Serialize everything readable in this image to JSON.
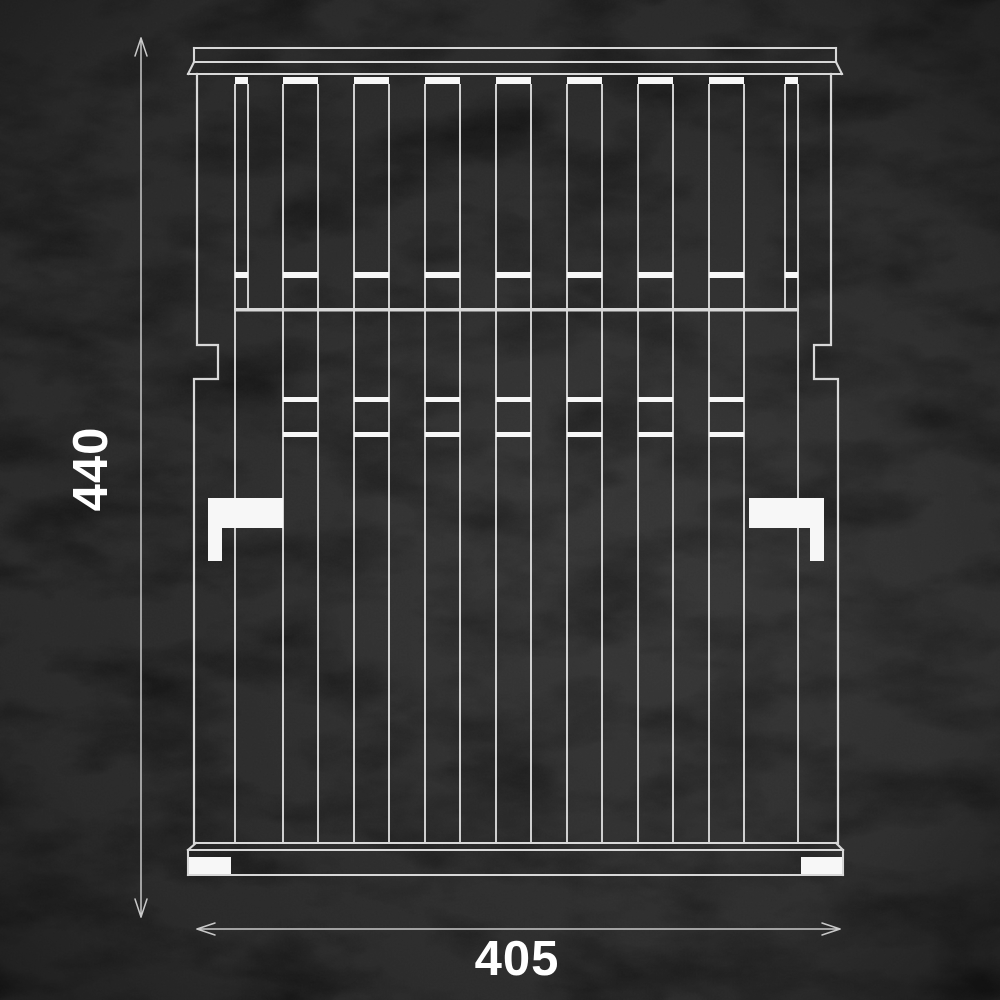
{
  "scene": {
    "description": "White technical line drawing of a dish-rack front elevation on a black slate background with two dimension callouts"
  },
  "dimensions": {
    "height_label": "440",
    "width_label": "405"
  },
  "structure": {
    "upper_slat_count": 9,
    "lower_wire_pair_count": 7,
    "side_bracket_count": 2,
    "foot_count": 2
  },
  "style": {
    "background_color": "#151515",
    "line_color": "#d8d8d8",
    "highlight_fill": "#f7f7f7",
    "dimension_line_color": "#c9c9c9",
    "label_color": "#ffffff"
  }
}
